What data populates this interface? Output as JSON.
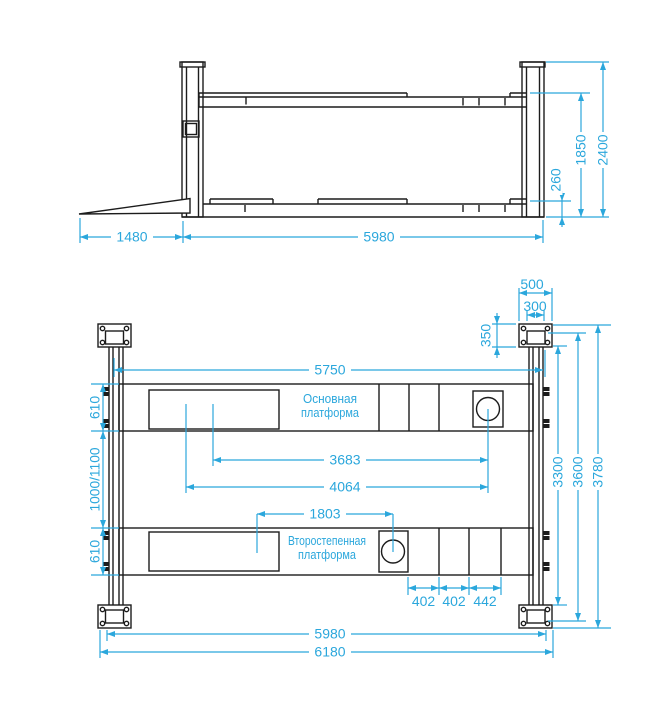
{
  "colors": {
    "ink": "#1c1c1c",
    "dim": "#2ba7dc",
    "background": "#ffffff"
  },
  "side_view": {
    "dim_ramp_length": "1480",
    "dim_length": "5980",
    "dim_drive_on_height": "260",
    "dim_lift_height": "1850",
    "dim_post_height": "2400"
  },
  "plan_view": {
    "label_main_platform_line1": "Основная",
    "label_main_platform_line2": "платформа",
    "label_secondary_platform_line1": "Второстепенная",
    "label_secondary_platform_line2": "платформа",
    "dim_platform_span": "5750",
    "dim_3683": "3683",
    "dim_4064": "4064",
    "dim_1803": "1803",
    "dim_platform_width_top": "610",
    "dim_track_width": "1000/1100",
    "dim_platform_width_bottom": "610",
    "dim_base_plate_width": "500",
    "dim_base_plate_inner": "300",
    "dim_base_plate_depth": "350",
    "dim_width_3300": "3300",
    "dim_width_3600": "3600",
    "dim_width_3780": "3780",
    "dim_segment_1": "402",
    "dim_segment_2": "402",
    "dim_segment_3": "442",
    "dim_length_5980": "5980",
    "dim_overall_length": "6180"
  }
}
